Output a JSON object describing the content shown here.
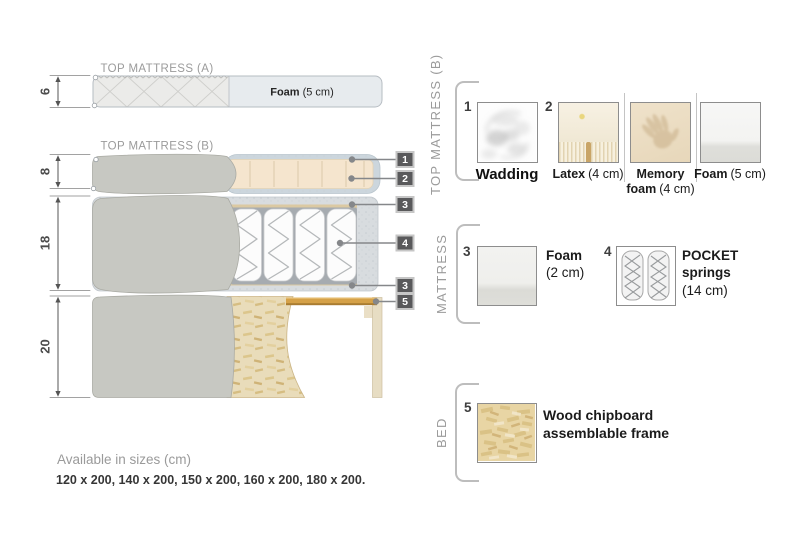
{
  "diagram": {
    "title_a": "TOP MATTRESS (A)",
    "title_b": "TOP MATTRESS (B)",
    "foam_a": {
      "name": "Foam",
      "detail": "(5 cm)"
    },
    "dim_6": "6",
    "dim_8": "8",
    "dim_18": "18",
    "dim_20": "20",
    "badge_1": "1",
    "badge_2": "2",
    "badge_3": "3",
    "badge_4": "4",
    "badge_3b": "3",
    "badge_5": "5"
  },
  "legend": {
    "group1_label": "TOP MATTRESS (B)",
    "group2_label": "MATTRESS",
    "group3_label": "BED",
    "wadding": {
      "num": "1",
      "name": "Wadding"
    },
    "latex": {
      "num": "2",
      "name": "Latex",
      "detail": "(4 cm)"
    },
    "memory": {
      "name": "Memory foam",
      "detail": "(4 cm)"
    },
    "foam5": {
      "name": "Foam",
      "detail": "(5 cm)"
    },
    "foam2": {
      "num": "3",
      "name": "Foam",
      "detail": "(2 cm)"
    },
    "pocket": {
      "num": "4",
      "name": "POCKET springs",
      "detail": "(14 cm)"
    },
    "wood": {
      "num": "5",
      "name": "Wood chipboard assemblable frame"
    }
  },
  "footer": {
    "title": "Available in sizes (cm)",
    "sizes": "120 x 200, 140 x 200, 150 x 200, 160 x 200, 180 x 200."
  },
  "colors": {
    "badge_bg": "#59595b",
    "fabric_gray": "#c7c8c2",
    "foam_beige": "#f5e5ce",
    "wadding_wrap": "#ccd6dd",
    "wood_slat": "#d5a148",
    "chipboard_tan": "#e9dcba",
    "label_gray": "#9b9b9b"
  }
}
